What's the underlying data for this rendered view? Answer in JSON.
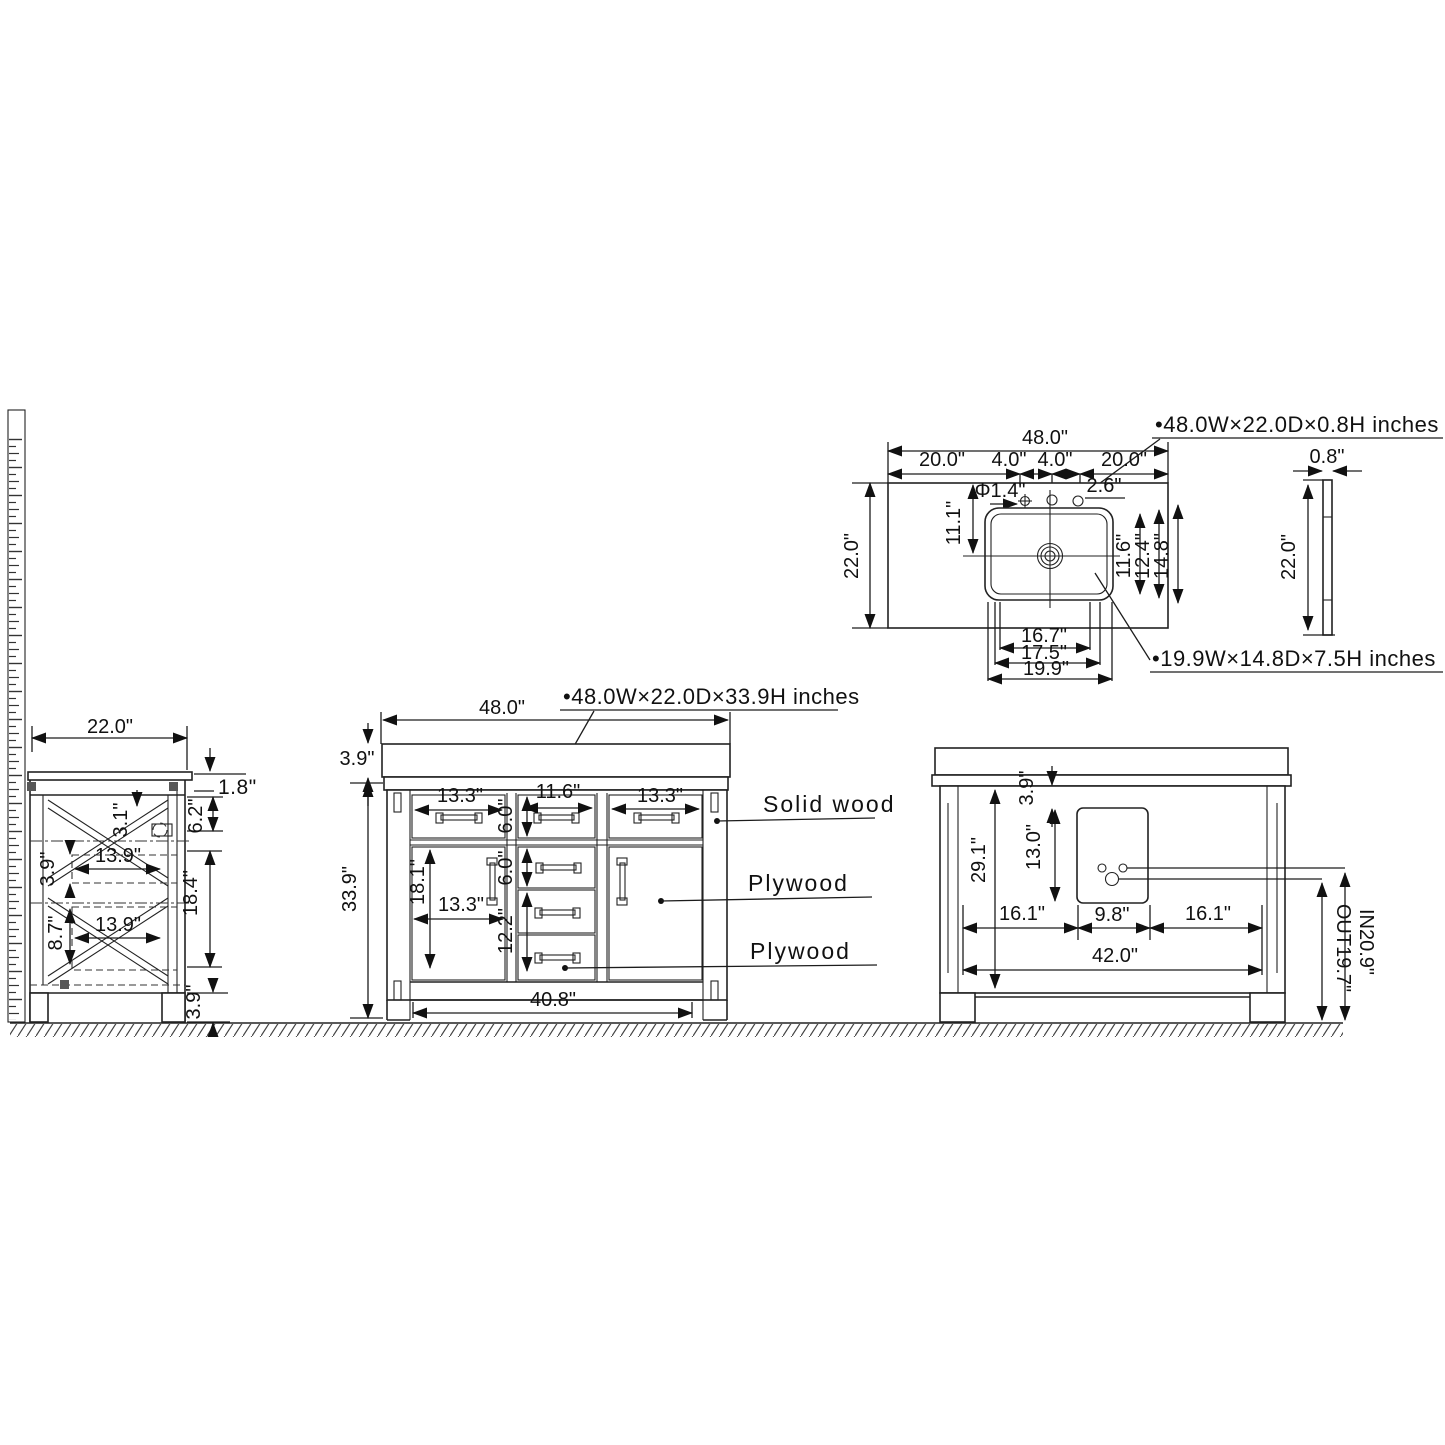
{
  "drawing": {
    "side_view": {
      "width": "22.0\"",
      "counter_thickness": "1.8\"",
      "rail": "3.1\"",
      "gap": "6.2\"",
      "box_h_top": "3.9\"",
      "box_w_top": "13.9\"",
      "opening": "18.4\"",
      "box_h_bottom": "8.7\"",
      "box_w_bottom": "13.9\"",
      "leg_h": "3.9\""
    },
    "front_view": {
      "label": "•48.0W×22.0D×33.9H inches",
      "width": "48.0\"",
      "counter_h": "3.9\"",
      "height": "33.9\"",
      "drawer_left": "13.3\"",
      "drawer_center": "11.6\"",
      "drawer_right": "13.3\"",
      "drawer_depth": "6.0\"",
      "door_h": "18.1\"",
      "door_w": "13.3\"",
      "stack_mid": "6.0\"",
      "stack_lower": "12.2\"",
      "base_w": "40.8\"",
      "material_frame": "Solid wood",
      "material_door": "Plywood",
      "material_drawer": "Plywood"
    },
    "back_view": {
      "opening_h": "29.1\"",
      "cutout_offset": "3.9\"",
      "cutout_h": "13.0\"",
      "seg_left": "16.1\"",
      "cutout_w": "9.8\"",
      "seg_right": "16.1\"",
      "width": "42.0\"",
      "inlet": "IN20.9\"",
      "outlet": "OUT19.7\""
    },
    "top_view": {
      "label": "•48.0W×22.0D×0.8H inches",
      "width": "48.0\"",
      "seg_left": "20.0\"",
      "seg_c1": "4.0\"",
      "seg_c2": "4.0\"",
      "seg_right": "20.0\"",
      "depth": "22.0\"",
      "hole_offset": "11.1\"",
      "hole_dia": "Φ1.4\"",
      "hole_spacing": "2.6\"",
      "sink_d1": "11.6\"",
      "sink_d2": "12.4\"",
      "sink_d3": "14.8\"",
      "sink_w1": "16.7\"",
      "sink_w2": "17.5\"",
      "sink_w3": "19.9\"",
      "sink_label": "•19.9W×14.8D×7.5H inches"
    },
    "edge_view": {
      "thickness": "0.8\"",
      "depth": "22.0\""
    }
  }
}
